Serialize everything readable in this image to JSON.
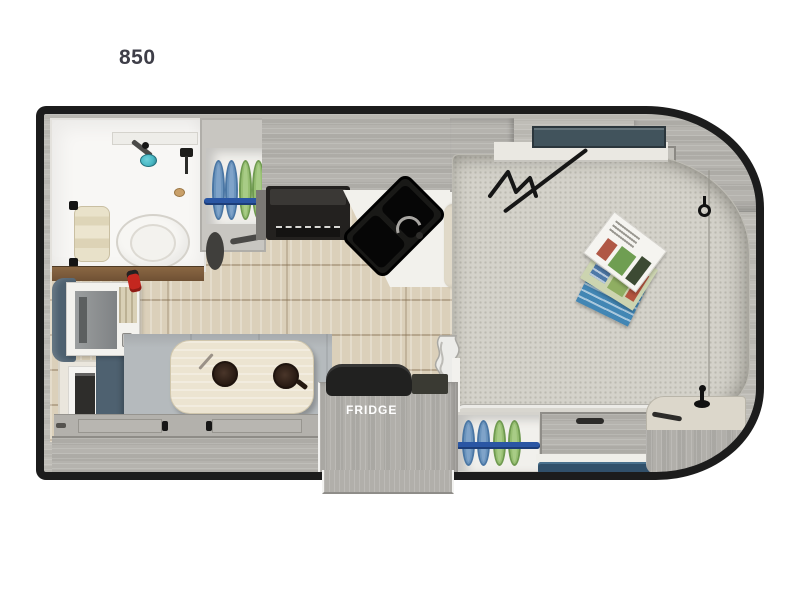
{
  "floorplan": {
    "model_label": "850",
    "fridge_label": "FRIDGE",
    "colors": {
      "wall": "#1c1c1c",
      "wood_floor": "#dbd0ba",
      "cabinet_gray": "#b5b3ae",
      "mattress_gray": "#d4d2ca",
      "bathroom_white": "#f8f7f5",
      "window_slate": "#41535c",
      "plate_blue": "#7fa3c9",
      "plate_green": "#a8cc86",
      "plate_rod_blue": "#2a56a4",
      "shower_teal": "#49b8c4",
      "step_mat_navy": "#31506a",
      "table_cream": "#ece4d1",
      "upholstery_slate": "#4e6170",
      "extinguisher_red": "#c4271f",
      "threshold_brown": "#7d5a3c"
    },
    "fixtures": [
      "wet-bath",
      "toilet",
      "shower-head",
      "towel",
      "dish-rack-upper",
      "dish-rack-lower",
      "cooktop",
      "corner-sink",
      "overhead-cabinets",
      "wardrobe",
      "tv",
      "window",
      "fire-extinguisher",
      "dinette-table",
      "coffee-mugs",
      "bench-seat",
      "fridge",
      "bed",
      "magazines",
      "bunk-ladder",
      "storage-drawer",
      "entry-step-mat",
      "corner-cabinet",
      "stuff-sack"
    ]
  }
}
